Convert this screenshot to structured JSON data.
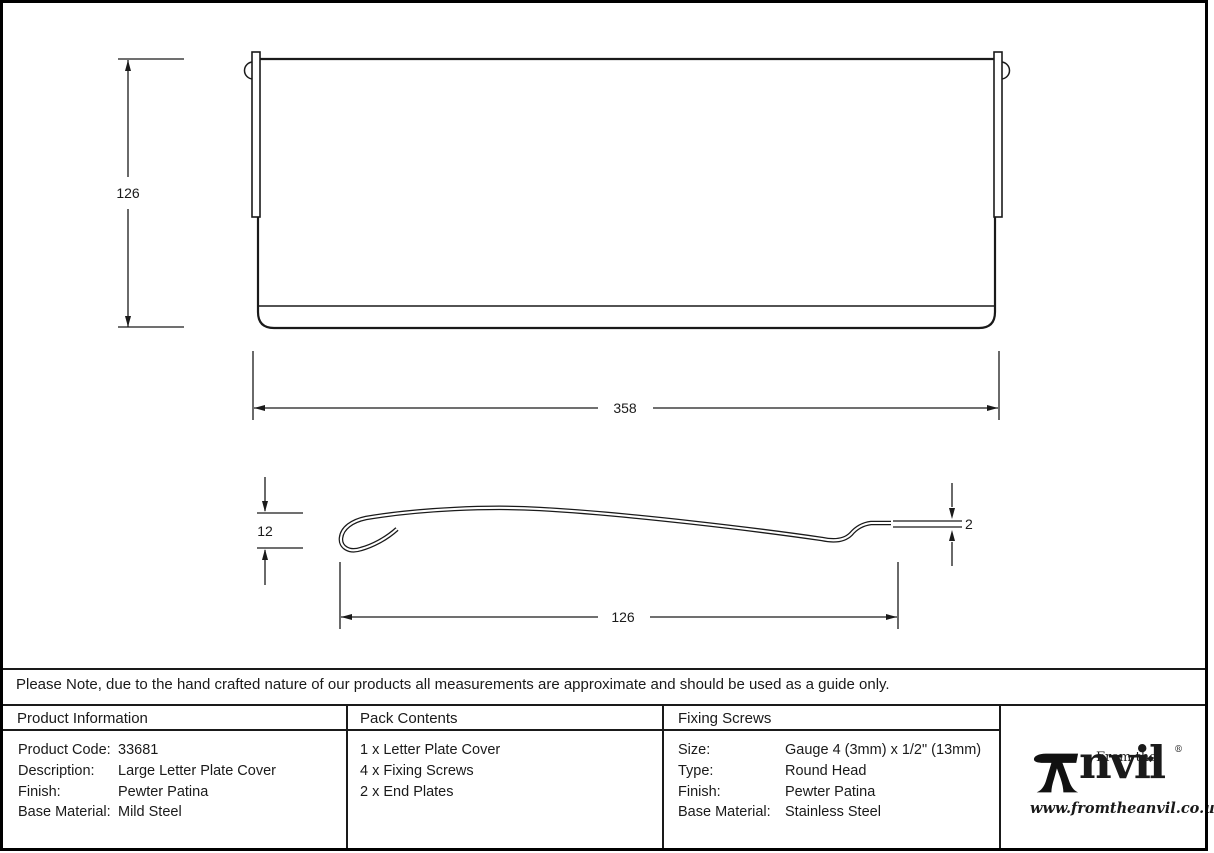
{
  "drawing": {
    "front_view": {
      "height_dim": "126",
      "width_dim": "358"
    },
    "side_view": {
      "curl_height_dim": "12",
      "thickness_dim": "2",
      "depth_dim": "126"
    }
  },
  "note": "Please Note, due to the hand crafted nature of our products all measurements are approximate and should be used as a guide only.",
  "table": {
    "product_information": {
      "header": "Product Information",
      "rows": [
        {
          "label": "Product Code:",
          "value": "33681"
        },
        {
          "label": "Description:",
          "value": "Large Letter Plate Cover"
        },
        {
          "label": "Finish:",
          "value": "Pewter Patina"
        },
        {
          "label": "Base Material:",
          "value": "Mild Steel"
        }
      ]
    },
    "pack_contents": {
      "header": "Pack Contents",
      "items": [
        "1 x Letter Plate Cover",
        "4 x Fixing Screws",
        "2 x End Plates"
      ]
    },
    "fixing_screws": {
      "header": "Fixing Screws",
      "rows": [
        {
          "label": "Size:",
          "value": "Gauge 4 (3mm) x 1/2\" (13mm)"
        },
        {
          "label": "Type:",
          "value": "Round Head"
        },
        {
          "label": "Finish:",
          "value": "Pewter Patina"
        },
        {
          "label": "Base Material:",
          "value": "Stainless Steel"
        }
      ]
    }
  },
  "logo": {
    "brand_prefix": "From the",
    "brand_name_rest": "nvil",
    "diamond": "◆",
    "registered": "®",
    "website": "www.fromtheanvil.co.uk"
  },
  "colors": {
    "line": "#1a1a1a",
    "background": "#ffffff"
  }
}
